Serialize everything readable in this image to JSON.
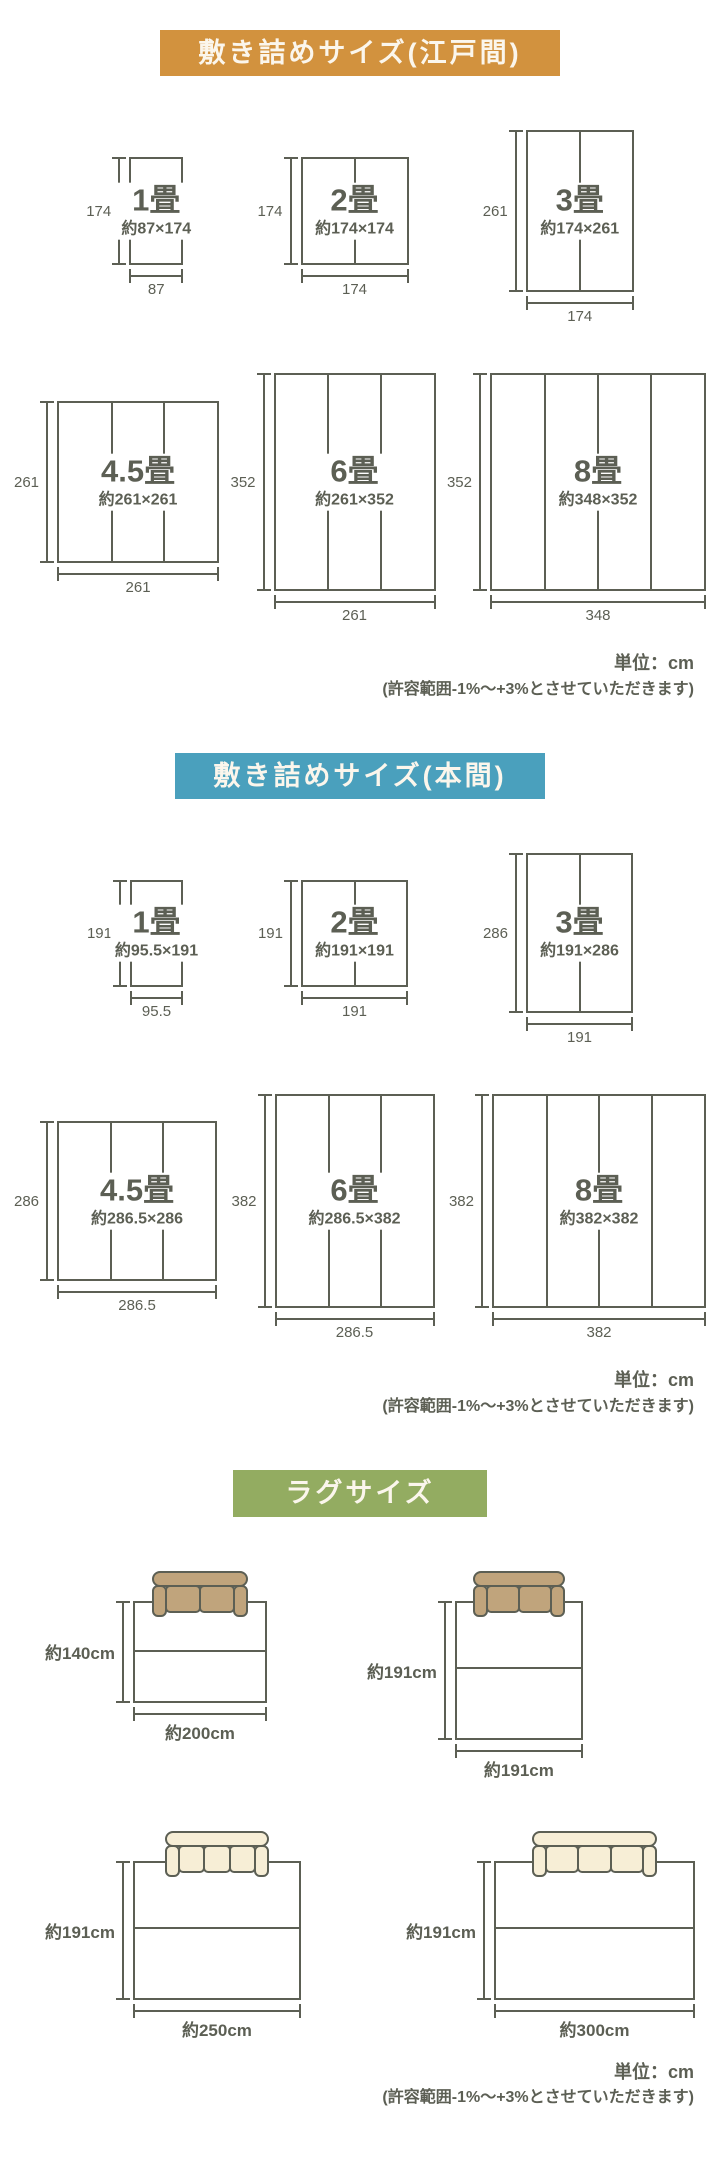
{
  "colors": {
    "background": "#ffffff",
    "line": "#5c5f54",
    "text": "#5c5f54",
    "edoma_header_bg": "#d2923e",
    "honma_header_bg": "#4aa0bd",
    "rug_header_bg": "#93ac61",
    "header_text": "#fbf6ec",
    "sofa_tan": "#c0a47c",
    "sofa_cream": "#f7eed6"
  },
  "sections": [
    {
      "id": "edoma",
      "title": "敷き詰めサイズ(江戸間)",
      "unit_note": "単位：cm",
      "tolerance_note": "(許容範囲-1%〜+3%とさせていただきます)",
      "diagram_rows": [
        [
          {
            "name": "1畳",
            "dims": "約87×174",
            "w": 87,
            "h": 174,
            "w_label": "87",
            "h_label": "174",
            "dividers": 0
          },
          {
            "name": "2畳",
            "dims": "約174×174",
            "w": 174,
            "h": 174,
            "w_label": "174",
            "h_label": "174",
            "dividers": 1
          },
          {
            "name": "3畳",
            "dims": "約174×261",
            "w": 174,
            "h": 261,
            "w_label": "174",
            "h_label": "261",
            "dividers": 1
          }
        ],
        [
          {
            "name": "4.5畳",
            "dims": "約261×261",
            "w": 261,
            "h": 261,
            "w_label": "261",
            "h_label": "261",
            "dividers": 2
          },
          {
            "name": "6畳",
            "dims": "約261×352",
            "w": 261,
            "h": 352,
            "w_label": "261",
            "h_label": "352",
            "dividers": 2
          },
          {
            "name": "8畳",
            "dims": "約348×352",
            "w": 348,
            "h": 352,
            "w_label": "348",
            "h_label": "352",
            "dividers": 3
          }
        ]
      ]
    },
    {
      "id": "honma",
      "title": "敷き詰めサイズ(本間)",
      "unit_note": "単位：cm",
      "tolerance_note": "(許容範囲-1%〜+3%とさせていただきます)",
      "diagram_rows": [
        [
          {
            "name": "1畳",
            "dims": "約95.5×191",
            "w": 95.5,
            "h": 191,
            "w_label": "95.5",
            "h_label": "191",
            "dividers": 0
          },
          {
            "name": "2畳",
            "dims": "約191×191",
            "w": 191,
            "h": 191,
            "w_label": "191",
            "h_label": "191",
            "dividers": 1
          },
          {
            "name": "3畳",
            "dims": "約191×286",
            "w": 191,
            "h": 286,
            "w_label": "191",
            "h_label": "286",
            "dividers": 1
          }
        ],
        [
          {
            "name": "4.5畳",
            "dims": "約286.5×286",
            "w": 286.5,
            "h": 286,
            "w_label": "286.5",
            "h_label": "286",
            "dividers": 2
          },
          {
            "name": "6畳",
            "dims": "約286.5×382",
            "w": 286.5,
            "h": 382,
            "w_label": "286.5",
            "h_label": "382",
            "dividers": 2
          },
          {
            "name": "8畳",
            "dims": "約382×382",
            "w": 382,
            "h": 382,
            "w_label": "382",
            "h_label": "382",
            "dividers": 3
          }
        ]
      ]
    }
  ],
  "rug_section": {
    "title": "ラグサイズ",
    "unit_note": "単位：cm",
    "tolerance_note": "(許容範囲-1%〜+3%とさせていただきます)",
    "rugs": [
      {
        "h_label": "約140cm",
        "w_label": "約200cm",
        "w": 200,
        "h": 140,
        "sofa_color": "tan",
        "cushions": 2
      },
      {
        "h_label": "約191cm",
        "w_label": "約191cm",
        "w": 191,
        "h": 191,
        "sofa_color": "tan",
        "cushions": 2
      },
      {
        "h_label": "約191cm",
        "w_label": "約250cm",
        "w": 250,
        "h": 191,
        "sofa_color": "cream",
        "cushions": 3
      },
      {
        "h_label": "約191cm",
        "w_label": "約300cm",
        "w": 300,
        "h": 191,
        "sofa_color": "cream",
        "cushions": 3
      }
    ]
  }
}
